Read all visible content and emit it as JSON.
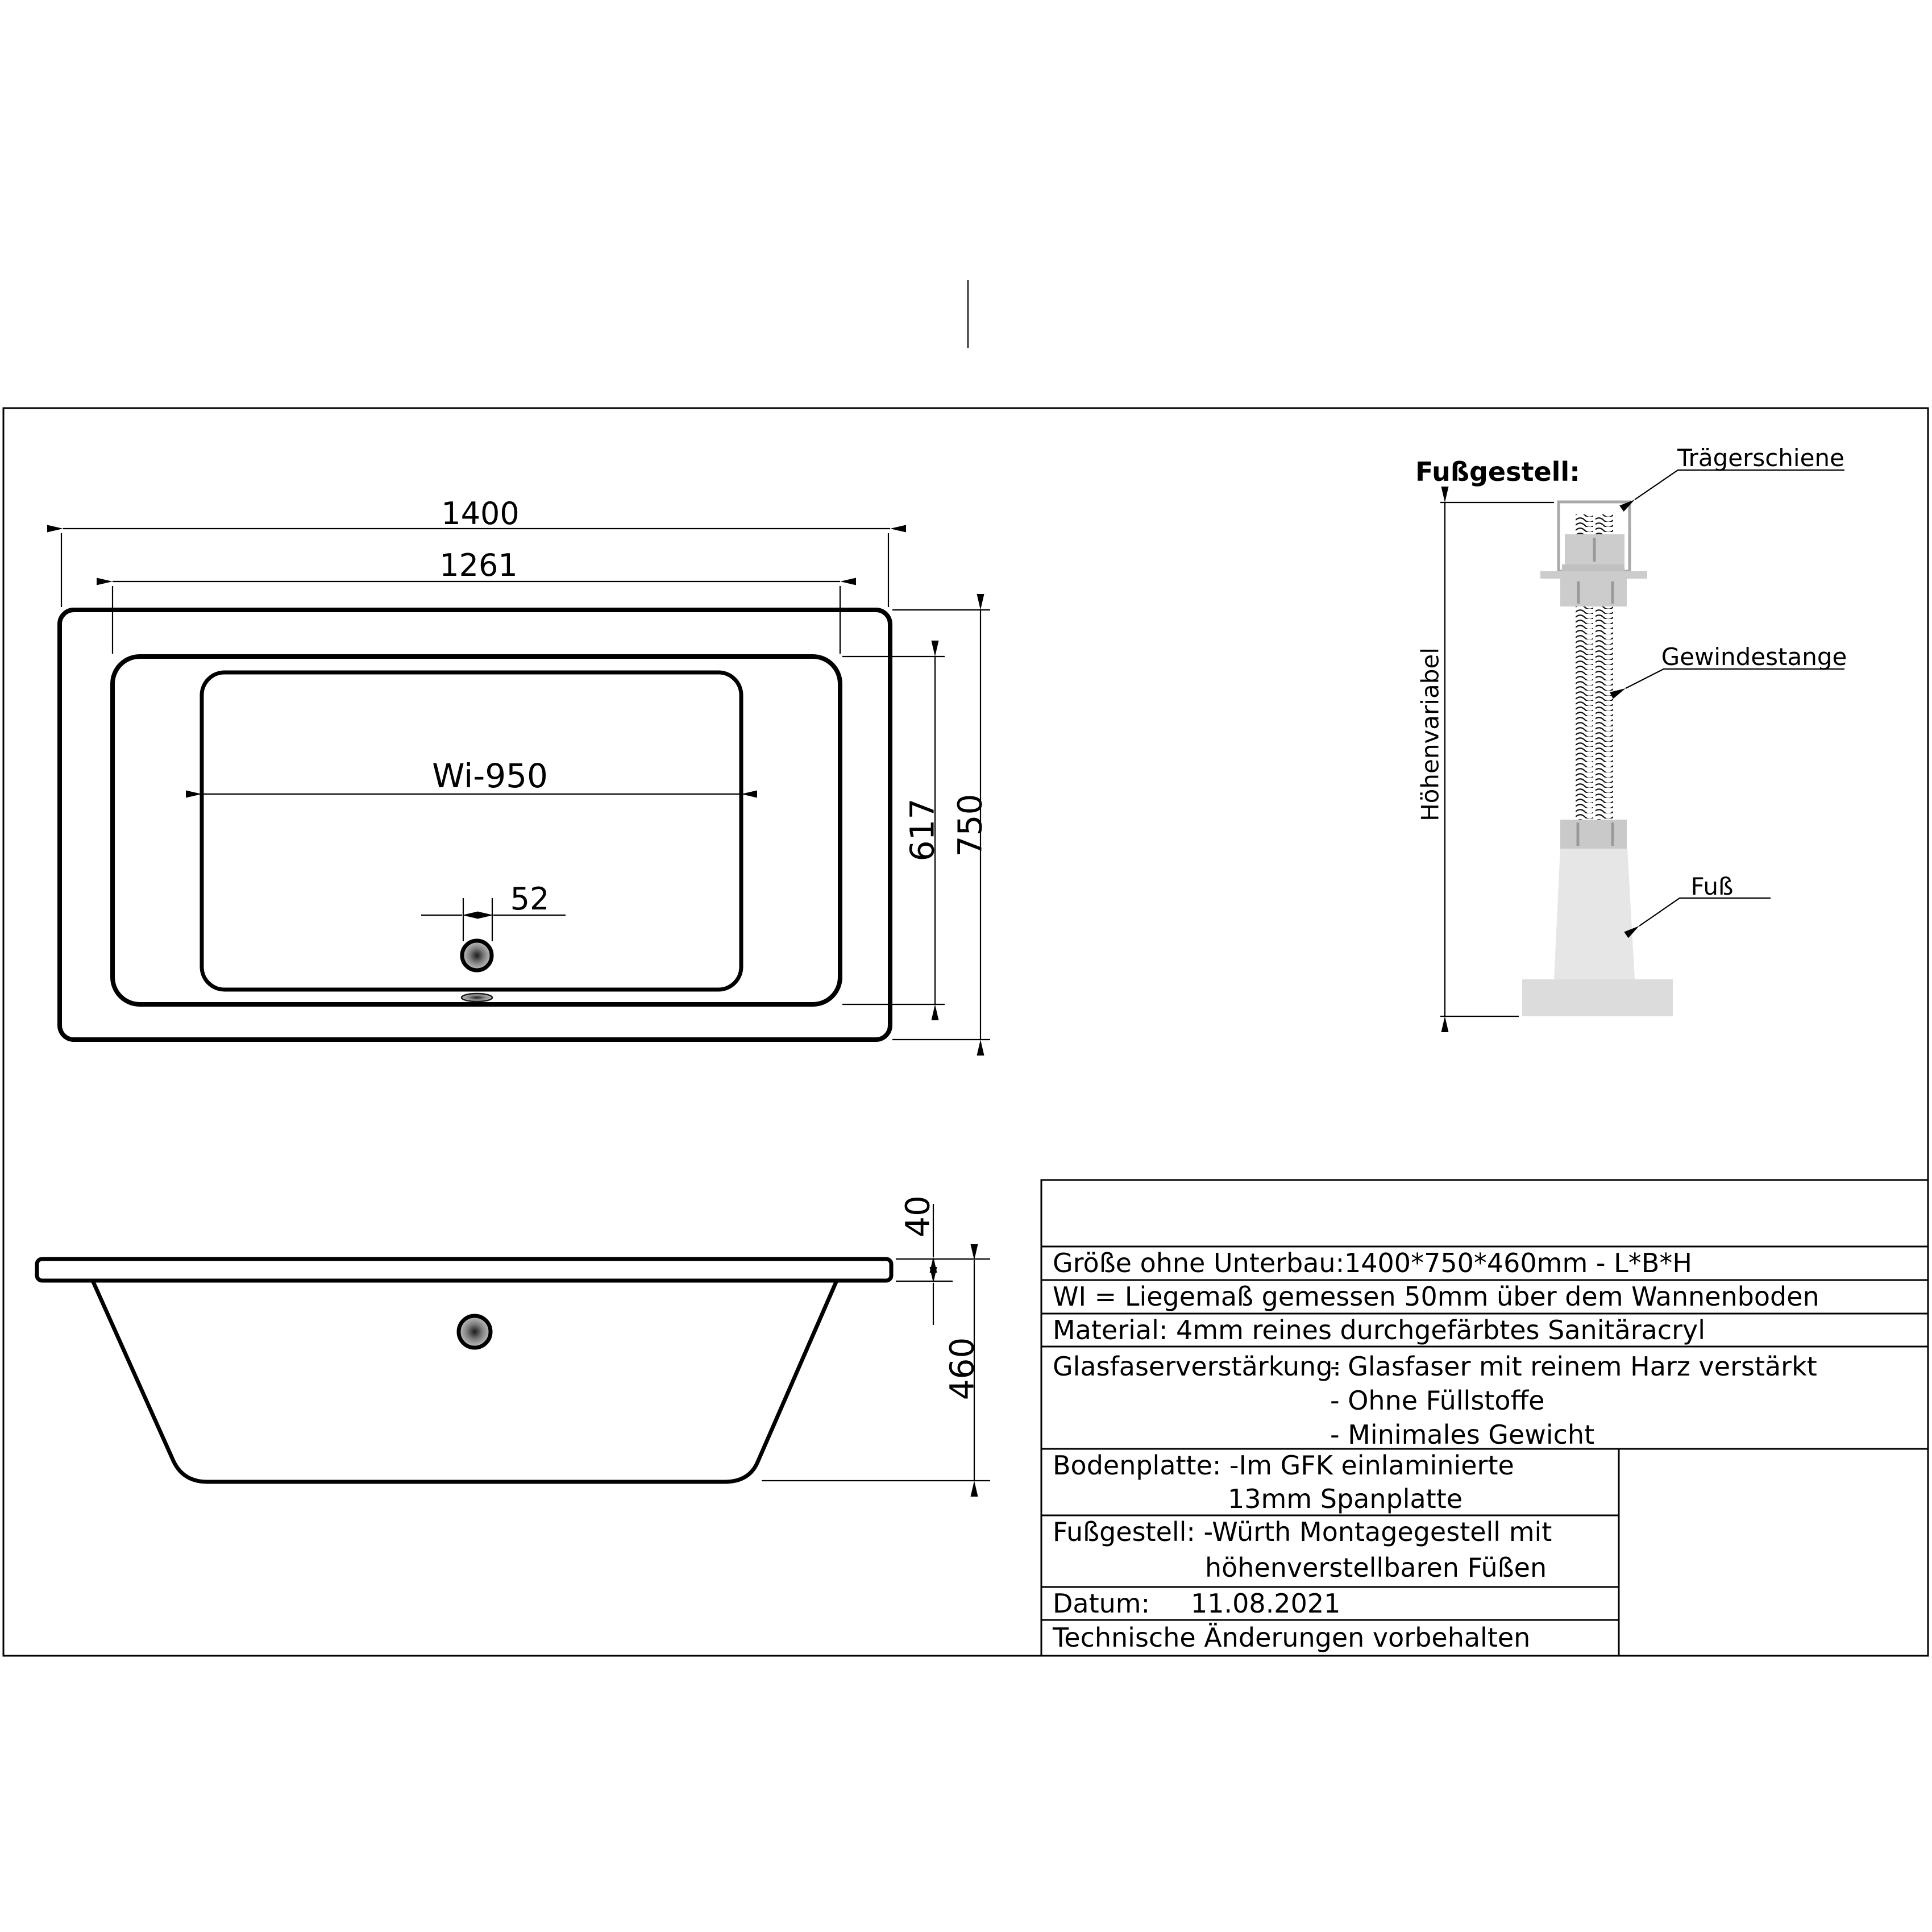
{
  "drawing": {
    "plan_view": {
      "overall_length": "1400",
      "inner_rim_length": "1261",
      "lying_dimension": "Wi-950",
      "drain_diameter": "52",
      "inner_rim_width": "617",
      "overall_width": "750"
    },
    "side_view": {
      "rim_thickness": "40",
      "total_height": "460"
    },
    "foot_assembly": {
      "title": "Fußgestell:",
      "carrier_rail_label": "Trägerschiene",
      "threaded_rod_label": "Gewindestange",
      "foot_label": "Fuß",
      "height_variable_label": "Höhenvariabel"
    }
  },
  "info_table": {
    "size_label": "Größe ohne Unterbau:",
    "size_value": "1400*750*460mm  -  L*B*H",
    "wi_note": "WI = Liegemaß gemessen 50mm über dem Wannenboden",
    "material": "Material: 4mm reines durchgefärbtes Sanitäracryl",
    "fiberglass_label": "Glasfaserverstärkung:",
    "fiberglass_item1": "- Glasfaser mit reinem Harz verstärkt",
    "fiberglass_item2": "- Ohne Füllstoffe",
    "fiberglass_item3": "- Minimales Gewicht",
    "baseplate_label": "Bodenplatte: -Im GFK einlaminierte",
    "baseplate_cont": "13mm Spanplatte",
    "footframe_label": "Fußgestell: -Würth Montagegestell mit",
    "footframe_cont": "höhenverstellbaren Füßen",
    "date_label": "Datum:",
    "date_value": "11.08.2021",
    "disclaimer": "Technische Änderungen vorbehalten"
  },
  "colors": {
    "line": "#000000",
    "foot_fill": "#e6e6e6",
    "base_fill": "#dcdcdc",
    "nut_fill": "#cccccc",
    "nut_fill_dark": "#c9c9c9",
    "flange_fill": "#c0c0c0",
    "facet_line": "#999999",
    "bracket_stroke": "#a9a9a9"
  }
}
